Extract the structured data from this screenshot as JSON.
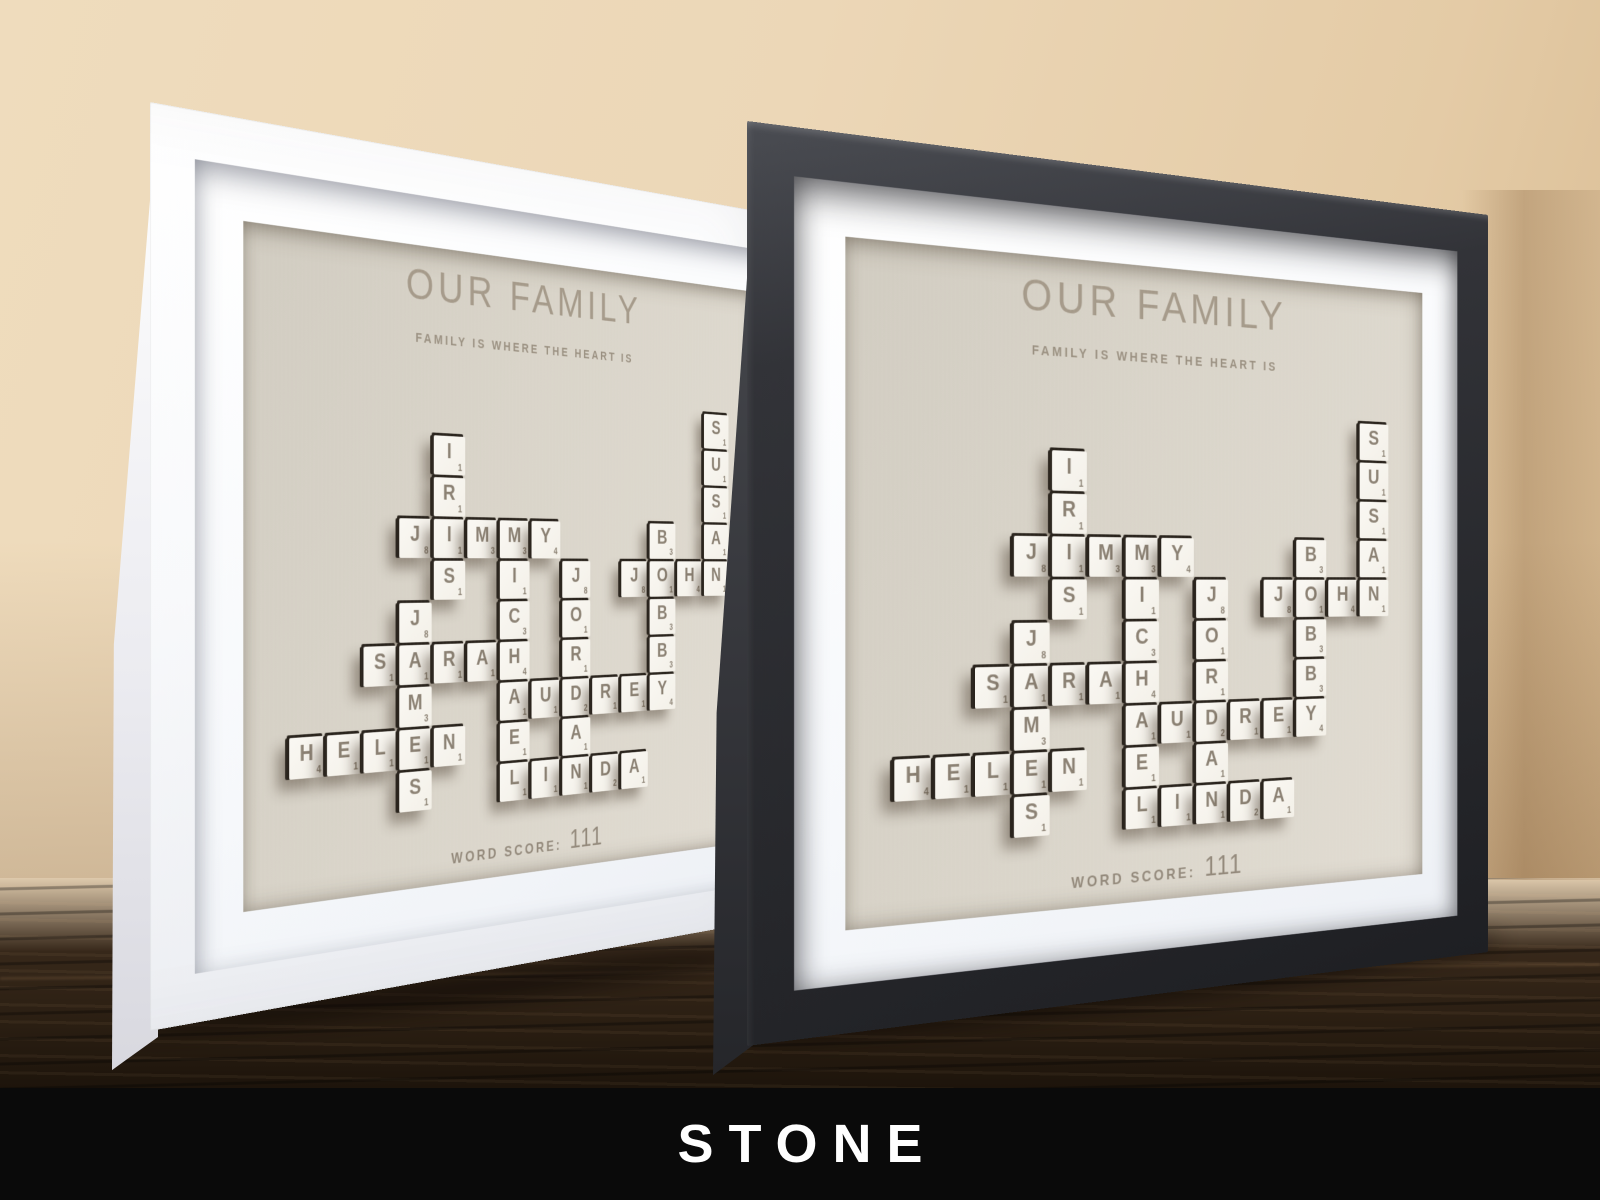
{
  "banner": {
    "label": "STONE"
  },
  "artwork": {
    "title": "OUR FAMILY",
    "subtitle": "FAMILY IS WHERE THE HEART IS",
    "score_label": "WORD SCORE:",
    "score_value": "111",
    "words": [
      "IRIS",
      "JIMMY",
      "SUSAN",
      "JOHN",
      "BOBBY",
      "MICHAEL",
      "JORDAN",
      "SARAH",
      "JAMES",
      "AUDREY",
      "HELEN",
      "LINDA"
    ],
    "grid": {
      "rows": 10,
      "cols": 14
    },
    "tiles": [
      {
        "r": 0,
        "c": 13,
        "l": "S",
        "v": 1
      },
      {
        "r": 1,
        "c": 4,
        "l": "I",
        "v": 1
      },
      {
        "r": 1,
        "c": 13,
        "l": "U",
        "v": 1
      },
      {
        "r": 2,
        "c": 4,
        "l": "R",
        "v": 1
      },
      {
        "r": 2,
        "c": 13,
        "l": "S",
        "v": 1
      },
      {
        "r": 3,
        "c": 3,
        "l": "J",
        "v": 8
      },
      {
        "r": 3,
        "c": 4,
        "l": "I",
        "v": 1
      },
      {
        "r": 3,
        "c": 5,
        "l": "M",
        "v": 3
      },
      {
        "r": 3,
        "c": 6,
        "l": "M",
        "v": 3
      },
      {
        "r": 3,
        "c": 7,
        "l": "Y",
        "v": 4
      },
      {
        "r": 3,
        "c": 11,
        "l": "B",
        "v": 3
      },
      {
        "r": 3,
        "c": 13,
        "l": "A",
        "v": 1
      },
      {
        "r": 4,
        "c": 4,
        "l": "S",
        "v": 1
      },
      {
        "r": 4,
        "c": 6,
        "l": "I",
        "v": 1
      },
      {
        "r": 4,
        "c": 8,
        "l": "J",
        "v": 8
      },
      {
        "r": 4,
        "c": 10,
        "l": "J",
        "v": 8
      },
      {
        "r": 4,
        "c": 11,
        "l": "O",
        "v": 1
      },
      {
        "r": 4,
        "c": 12,
        "l": "H",
        "v": 4
      },
      {
        "r": 4,
        "c": 13,
        "l": "N",
        "v": 1
      },
      {
        "r": 5,
        "c": 3,
        "l": "J",
        "v": 8
      },
      {
        "r": 5,
        "c": 6,
        "l": "C",
        "v": 3
      },
      {
        "r": 5,
        "c": 8,
        "l": "O",
        "v": 1
      },
      {
        "r": 5,
        "c": 11,
        "l": "B",
        "v": 3
      },
      {
        "r": 6,
        "c": 2,
        "l": "S",
        "v": 1
      },
      {
        "r": 6,
        "c": 3,
        "l": "A",
        "v": 1
      },
      {
        "r": 6,
        "c": 4,
        "l": "R",
        "v": 1
      },
      {
        "r": 6,
        "c": 5,
        "l": "A",
        "v": 1
      },
      {
        "r": 6,
        "c": 6,
        "l": "H",
        "v": 4
      },
      {
        "r": 6,
        "c": 8,
        "l": "R",
        "v": 1
      },
      {
        "r": 6,
        "c": 11,
        "l": "B",
        "v": 3
      },
      {
        "r": 7,
        "c": 3,
        "l": "M",
        "v": 3
      },
      {
        "r": 7,
        "c": 6,
        "l": "A",
        "v": 1
      },
      {
        "r": 7,
        "c": 7,
        "l": "U",
        "v": 1
      },
      {
        "r": 7,
        "c": 8,
        "l": "D",
        "v": 2
      },
      {
        "r": 7,
        "c": 9,
        "l": "R",
        "v": 1
      },
      {
        "r": 7,
        "c": 10,
        "l": "E",
        "v": 1
      },
      {
        "r": 7,
        "c": 11,
        "l": "Y",
        "v": 4
      },
      {
        "r": 8,
        "c": 0,
        "l": "H",
        "v": 4
      },
      {
        "r": 8,
        "c": 1,
        "l": "E",
        "v": 1
      },
      {
        "r": 8,
        "c": 2,
        "l": "L",
        "v": 1
      },
      {
        "r": 8,
        "c": 3,
        "l": "E",
        "v": 1
      },
      {
        "r": 8,
        "c": 4,
        "l": "N",
        "v": 1
      },
      {
        "r": 8,
        "c": 6,
        "l": "E",
        "v": 1
      },
      {
        "r": 8,
        "c": 8,
        "l": "A",
        "v": 1
      },
      {
        "r": 9,
        "c": 3,
        "l": "S",
        "v": 1
      },
      {
        "r": 9,
        "c": 6,
        "l": "L",
        "v": 1
      },
      {
        "r": 9,
        "c": 7,
        "l": "I",
        "v": 1
      },
      {
        "r": 9,
        "c": 8,
        "l": "N",
        "v": 1
      },
      {
        "r": 9,
        "c": 9,
        "l": "D",
        "v": 2
      },
      {
        "r": 9,
        "c": 10,
        "l": "A",
        "v": 1
      }
    ]
  },
  "frames": [
    {
      "id": "white-frame",
      "frame_color": "#f7f8fa"
    },
    {
      "id": "black-frame",
      "frame_color": "#2b2c30"
    }
  ],
  "colors": {
    "wall": "#e9d4b6",
    "wood_surface": "#322417",
    "banner_background": "#0a0a0a",
    "banner_text": "#ffffff",
    "panel": "#d9d4c9",
    "mat": "#f8fafc",
    "tile_face": "#f7f4ed",
    "tile_edge": "#2a241d",
    "tile_letter": "#8b8173",
    "engraved_text": "#a59a8a"
  }
}
